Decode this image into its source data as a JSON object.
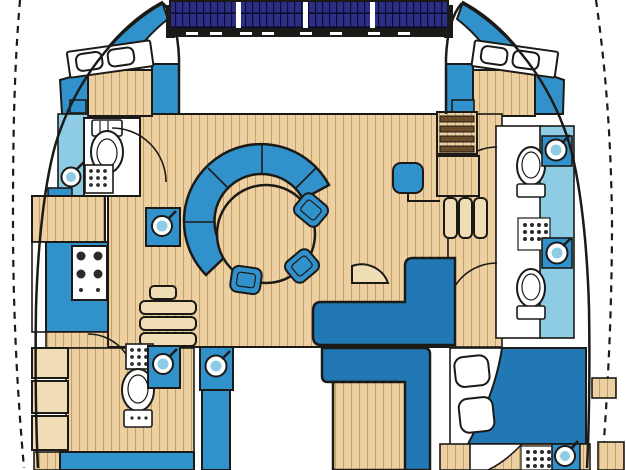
{
  "title": "Catamaran yacht interior floor plan (top-down deck layout)",
  "palette": {
    "wood": "#ecd0a2",
    "woodLine": "#c69f63",
    "woodLight": "#f0ddb6",
    "blue": "#3191cb",
    "blueDark": "#2277b5",
    "lightblue": "#8ecbe4",
    "navy": "#2d2f86",
    "outline": "#1c1a17",
    "stepDark": "#6b4a2a",
    "white": "#ffffff"
  },
  "inventory": {
    "solar_panels": 4,
    "cabins": 3,
    "double_berths": 3,
    "heads_bathrooms": 4,
    "toilets": 4,
    "round_sinks": 7,
    "shower_drains": 4,
    "stove_burners": 4,
    "salon_chairs": 3,
    "dining_tables": 2,
    "companionway_step_sets": 4
  },
  "rooms": [
    "port-forward-cabin",
    "port-forward-head",
    "galley",
    "salon-dinette",
    "navigation-station",
    "port-aft-head",
    "starboard-forward-cabin",
    "starboard-forward-head",
    "starboard-aft-head",
    "starboard-aft-cabin",
    "aft-cockpit"
  ]
}
